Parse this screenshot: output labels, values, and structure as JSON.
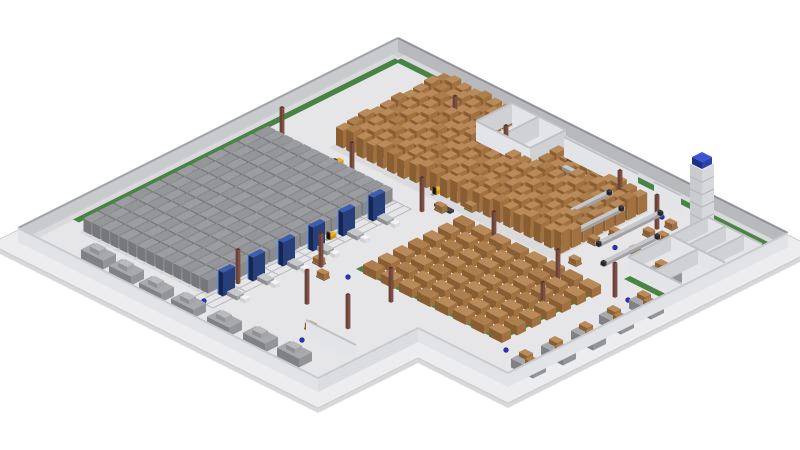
{
  "scene": {
    "description": "3D isometric render of an automated warehouse facility",
    "background": "#ffffff",
    "palette": {
      "slab": "#ededf0",
      "slab_side": "#d8d8db",
      "slab_edge": "#c9c9cc",
      "floor": "#e6e6e9",
      "green": "#3f7f3b",
      "wall_ne_face": "#b7b9bc",
      "wall_ne_cap": "#8f9194",
      "wall_nw_face": "#c9cbce",
      "wall_nw_cap": "#9fa1a4",
      "wall_out_face": "#e2e3e6",
      "wall_out_cap": "#c8cacd",
      "room_face_px": "#cfd1d4",
      "room_face_py": "#e3e4e7",
      "room_cap": "#bfc1c4",
      "box_top": "#b98a5a",
      "box_top_alt": "#ad7e4e",
      "box_right": "#a1713f",
      "box_front": "#8a5e33",
      "gray_top": "#9c9da1",
      "gray_top_alt": "#95969a",
      "gray_right": "#8a8b8f",
      "gray_front": "#77787c",
      "cluster_top": "#a8a9ad",
      "cluster_right": "#939498",
      "cluster_front": "#808185",
      "machine_top": "#3a5fae",
      "machine_right": "#27407c",
      "machine_front": "#18264e",
      "machine_edge": "#4a90ff",
      "conveyor_top": "#c6c8cb",
      "conveyor_right": "#9fa1a4",
      "conveyor_front": "#8b8d90",
      "conveyor_dark": "#3a3a3e",
      "conveyor_white_top": "#eef0f2",
      "conveyor_white_side": "#d3d5d8",
      "tower_top": "#e8e9ec",
      "tower_right": "#d7d8db",
      "tower_front": "#c9cbce",
      "tower_line": "#b0b2b6",
      "tower_cap_top": "#3b55d6",
      "tower_cap_right": "#2c41ab",
      "tower_cap_front": "#1f2f86",
      "forklift_top": "#f0b429",
      "forklift_right": "#d29a1d",
      "forklift_front": "#b98416",
      "forklift_dark": "#26262a",
      "column_top": "#55332b",
      "column_right": "#7e5044",
      "column_front": "#6b4238",
      "dot_fill": "#2a35b8",
      "dot_stroke": "#151c6e",
      "rail": "#b9babd",
      "cart_top": "#f4f4f6",
      "cart_right": "#dcdde0",
      "cart_front": "#cfd0d3",
      "shadow": "rgba(0,0,0,0.05)"
    },
    "building": {
      "origin": [
        398,
        52
      ],
      "width": 390,
      "depth": 380,
      "notch_x": 300,
      "notch_y": 280,
      "apron": 14,
      "wall_height": 14
    },
    "zones": {
      "block_storage_gray": {
        "x0": 22,
        "pitch": 9,
        "rows": 14,
        "y0": 152,
        "y1": 338,
        "seg_len": 14,
        "seg_gap": 1.5,
        "width": 7.5,
        "height": 13
      },
      "pallet_racking": {
        "x0": 62,
        "pitch": 10.2,
        "rows": 22,
        "y_end": 128,
        "width": 7,
        "seg_len": 9,
        "seg_gap": 2,
        "heights": [
          18,
          21,
          19
        ],
        "y_start_rules": [
          [
            128,
            16
          ],
          [
            185,
            58
          ],
          [
            400,
            34
          ]
        ]
      },
      "floor_stack_grid": {
        "x0": 204,
        "cols": 8,
        "col_pitch": 18,
        "y0": 140,
        "rows": 7,
        "row_pitch": 15,
        "w": 13,
        "d": 9,
        "h": 9
      },
      "green_markings": [
        [
          8,
          5,
          385,
          11
        ],
        [
          5,
          8,
          11,
          330
        ],
        [
          196,
          232,
          340,
          238
        ],
        [
          334,
          140,
          340,
          238
        ],
        [
          340,
          108,
          389,
          114
        ]
      ],
      "rails": {
        "lines": [
          142,
          149,
          156,
          163
        ],
        "y0": 150,
        "y1": 348,
        "ties": {
          "y0": 150,
          "pitch": 33,
          "n": 7,
          "x0": 140,
          "x1": 164
        }
      },
      "machines": {
        "x": 152,
        "ys": [
          170,
          200,
          230,
          260,
          290,
          320
        ],
        "w": 5,
        "d": 12,
        "h": 24
      },
      "conveyors": [
        {
          "x": 246,
          "y0": 35,
          "y1": 100
        },
        {
          "x": 268,
          "y0": 45,
          "y1": 112
        },
        {
          "x": 292,
          "y0": 30,
          "y1": 95
        },
        {
          "x": 314,
          "y0": 55,
          "y1": 112
        },
        {
          "x": 326,
          "y0": 30,
          "y1": 95,
          "white": true
        }
      ],
      "conveyor_horizontal": {
        "y": 32,
        "x0": 200,
        "x1": 236
      },
      "tower": {
        "x": 320,
        "y": 16,
        "size": 12,
        "h": 62
      },
      "rooms_top": {
        "h": 20,
        "walls": [
          [
            128,
            14,
            182,
            14
          ],
          [
            128,
            14,
            128,
            50
          ],
          [
            155,
            14,
            155,
            50
          ],
          [
            182,
            14,
            182,
            50
          ],
          [
            128,
            50,
            182,
            50
          ]
        ]
      },
      "offices_right": {
        "h": 15,
        "walls": [
          [
            335,
            25,
            389,
            25
          ],
          [
            335,
            25,
            335,
            105
          ],
          [
            353,
            25,
            353,
            62
          ],
          [
            371,
            25,
            371,
            62
          ],
          [
            335,
            62,
            389,
            62
          ],
          [
            362,
            62,
            362,
            105
          ],
          [
            335,
            105,
            389,
            105
          ]
        ]
      },
      "interior_walls": [
        [
          188,
          22,
          262,
          22,
          20
        ],
        [
          278,
          22,
          305,
          22,
          20
        ],
        [
          238,
          330,
          288,
          330,
          16
        ]
      ],
      "pallet_clusters": {
        "w": 22,
        "d": 13,
        "h": 9,
        "items": [
          [
            48,
            352,
            0
          ],
          [
            78,
            354,
            0
          ],
          [
            110,
            356,
            0
          ],
          [
            142,
            356,
            0
          ],
          [
            178,
            356,
            0
          ],
          [
            212,
            354,
            0
          ],
          [
            244,
            352,
            0
          ],
          [
            372,
            128,
            1
          ],
          [
            372,
            158,
            1
          ],
          [
            374,
            188,
            1
          ],
          [
            374,
            218,
            1
          ],
          [
            372,
            246,
            1
          ],
          [
            350,
            88,
            1
          ]
        ]
      },
      "single_pallets": [
        [
          215,
          40
        ],
        [
          228,
          52
        ],
        [
          244,
          66
        ],
        [
          258,
          44
        ],
        [
          272,
          58
        ],
        [
          288,
          72
        ],
        [
          252,
          96
        ],
        [
          268,
          110
        ],
        [
          285,
          90
        ],
        [
          232,
          86
        ],
        [
          210,
          70
        ],
        [
          305,
          55
        ],
        [
          316,
          80
        ],
        [
          296,
          120
        ],
        [
          190,
          118
        ],
        [
          176,
          134
        ],
        [
          168,
          248
        ],
        [
          184,
          260
        ],
        [
          230,
          318
        ],
        [
          308,
          36
        ],
        [
          316,
          52
        ]
      ],
      "forklifts": [
        [
          158,
          118
        ],
        [
          170,
          90
        ],
        [
          186,
          56
        ],
        [
          234,
          36
        ],
        [
          264,
          102
        ],
        [
          150,
          216
        ],
        [
          62,
          143
        ],
        [
          80,
          139
        ],
        [
          333,
          212
        ]
      ],
      "columns": [
        [
          105,
          48
        ],
        [
          160,
          52
        ],
        [
          215,
          44
        ],
        [
          262,
          40
        ],
        [
          305,
          46
        ],
        [
          30,
          146
        ],
        [
          100,
          146
        ],
        [
          170,
          146
        ],
        [
          240,
          144
        ],
        [
          310,
          150
        ],
        [
          175,
          252
        ],
        [
          245,
          252
        ],
        [
          352,
          135
        ],
        [
          335,
          190
        ],
        [
          150,
          310
        ],
        [
          250,
          300
        ],
        [
          205,
          296
        ]
      ],
      "floor_dots": [
        [
          277,
          150
        ],
        [
          304,
          87
        ],
        [
          297,
          33
        ],
        [
          300,
          168
        ],
        [
          363,
          133
        ],
        [
          356,
          66
        ],
        [
          294,
          222
        ],
        [
          384,
          214
        ],
        [
          352,
          244
        ],
        [
          200,
          250
        ],
        [
          152,
          346
        ],
        [
          240,
          336
        ],
        [
          265,
          212
        ]
      ],
      "dark_bar": [
        172,
        132,
        16,
        4
      ]
    }
  }
}
